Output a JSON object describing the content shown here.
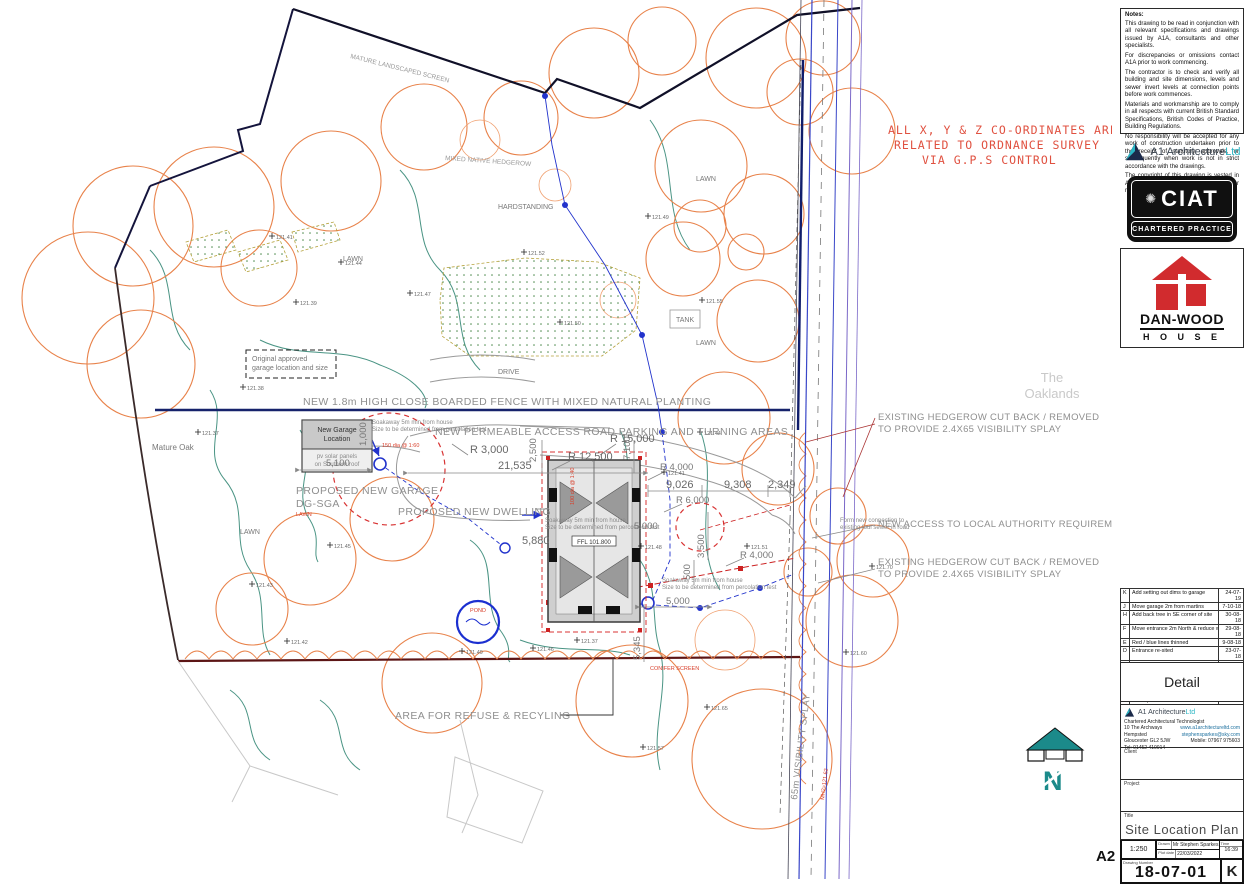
{
  "sheet": {
    "size": "A2"
  },
  "notes": {
    "title": "Notes:",
    "paras": [
      "This drawing to be read in conjunction with all relevant specifications and drawings issued by A1A, consultants and other specialists.",
      "For discrepancies or omissions contact A1A prior to work commencing.",
      "The contractor is to check and verify all building and site dimensions, levels and sewer invert levels at connection points before work commences.",
      "Materials and workmanship are to comply in all respects with current British Standard Specifications, British Codes of Practice, Building Regulations.",
      "No responsibility will be accepted for any work of construction undertaken prior to the receipt of statutory approvals, or subsequently when work is not in strict accordance with the drawings.",
      "The copyright of this drawing is vested in A1A and must not be copied or reproduced without written consent."
    ]
  },
  "coords_note": {
    "l1": "ALL X, Y & Z CO-ORDINATES ARE",
    "l2": "RELATED TO ORDNANCE SURVEY",
    "l3": "VIA G.P.S CONTROL"
  },
  "logos": {
    "a1": {
      "name": "A1 Architecture",
      "suffix": "Ltd"
    },
    "ciat": {
      "acronym": "CIAT",
      "subtitle": "CHARTERED PRACTICE",
      "emblem": "✺"
    },
    "danwood": {
      "line1": "DAN-WOOD",
      "line2": "H O U S E"
    }
  },
  "revisions": {
    "header": {
      "rev": "Rev",
      "desc": "Description",
      "date": "Date"
    },
    "rows": [
      {
        "rev": "K",
        "desc": "Add setting out dims to garage",
        "date": "24-07-19"
      },
      {
        "rev": "J",
        "desc": "Move garage 2m from martins",
        "date": "7-10-18"
      },
      {
        "rev": "H",
        "desc": "Add back tree in SE corner of site",
        "date": "30-08-18"
      },
      {
        "rev": "F",
        "desc": "Move entrance 2m North & reduce width",
        "date": "29-08-18"
      },
      {
        "rev": "E",
        "desc": "Red / blue lines thinned",
        "date": "9-08-18"
      },
      {
        "rev": "D",
        "desc": "Entrance re-sited",
        "date": "23-07-18"
      },
      {
        "rev": "C",
        "desc": "Original approved garage size corrected",
        "date": "29-05-18"
      },
      {
        "rev": "B",
        "desc": "Red / Blue lines added",
        "date": "14-05-18"
      },
      {
        "rev": "A",
        "desc": "Re-site garage",
        "date": "9-05-18"
      }
    ]
  },
  "detail": {
    "label": "Detail"
  },
  "titleblock": {
    "company": "A1 Architecture",
    "company_suffix": "Ltd",
    "role": "Chartered Architectural Technologist",
    "address1": "10 The Archways",
    "address2": "Hempsted",
    "address3": "Gloucester GL2 5JW",
    "tel": "Tel: 01452 410014",
    "web": "www.a1architectureltd.com",
    "email": "stephensparkes@sky.com",
    "mobile": "Mobile: 07967 975603",
    "client_label": "Client",
    "project_label": "Project",
    "title_label": "Title",
    "title": "Site Location Plan",
    "scale": "1:250",
    "drawn_label": "Drawn",
    "drawn": "Mr Stephen Sparkes",
    "plotdate_label": "Plot date",
    "plot_date": "22/03/2022",
    "time_label": "Time",
    "time": "16:39",
    "number_label": "Drawing Number",
    "number": "18-07-01",
    "revision": "K"
  },
  "plan": {
    "labels": {
      "fence": "NEW 1.8m HIGH CLOSE BOARDED FENCE WITH MIXED NATURAL PLANTING",
      "road": "NEW PERMEABLE ACCESS ROAD PARKING AND TURNING AREAS",
      "dwelling": "PROPOSED NEW DWELLING",
      "garage1": "PROPOSED NEW GARAGE",
      "garage2": "DG-SGA",
      "refuse": "AREA FOR REFUSE & RECYLING",
      "hedge1": "EXISTING HEDGEROW CUT BACK / REMOVED",
      "hedge2": "TO PROVIDE 2.4X65 VISIBILITY SPLAY",
      "access": "NEW ACCESS TO LOCAL AUTHORITY REQUIREMENTS",
      "ngarage1": "New Garage",
      "ngarage2": "Location",
      "solar1": "pv solar panels",
      "solar2": "on Southern roof",
      "orig1": "Original approved",
      "orig2": "garage location and size",
      "oak": "Mature Oak",
      "oaklands1": "The",
      "oaklands2": "Oaklands",
      "splay": "65m VISIBILITY SPLAY",
      "soak1": "Soakaway 5m min from house",
      "soak2": "Size to be determined from percolation test",
      "ffl": "FFL 101.800",
      "conifer": "CONIFER SCREEN",
      "sewer1": "Form new connection to",
      "sewer2": "existing foul sewer in road",
      "lawn": "LAWN",
      "tank": "TANK",
      "drive": "DRIVE",
      "hard": "HARDSTANDING",
      "pond": "POND",
      "mh": "MH2=121.62",
      "screen_top": "MATURE LANDSCAPED SCREEN",
      "hedgerow_mid": "MIXED NATIVE HEDGEROW",
      "dia150": "150 dia @ 1:60",
      "dia100": "100 dia @ 1:40",
      "north": "N"
    },
    "dims": [
      "1,000",
      "5,100",
      "R 3,000",
      "21,535",
      "2,500",
      "R 12,500",
      "R 15,000",
      "R 4,000",
      "9,026",
      "9,308",
      "2,349",
      "R 6,000",
      "5,880",
      "5,000",
      "3,500",
      "500",
      "R 4,000",
      "5,000",
      "5,345",
      "7,100"
    ],
    "levels": [
      "121.41",
      "121.44",
      "121.39",
      "121.47",
      "121.52",
      "121.49",
      "121.55",
      "121.50",
      "121.38",
      "121.37",
      "121.45",
      "121.43",
      "121.42",
      "121.49",
      "121.46",
      "121.37",
      "121.48",
      "121.41",
      "121.44",
      "121.51",
      "121.60",
      "121.70",
      "121.57",
      "121.65"
    ]
  }
}
